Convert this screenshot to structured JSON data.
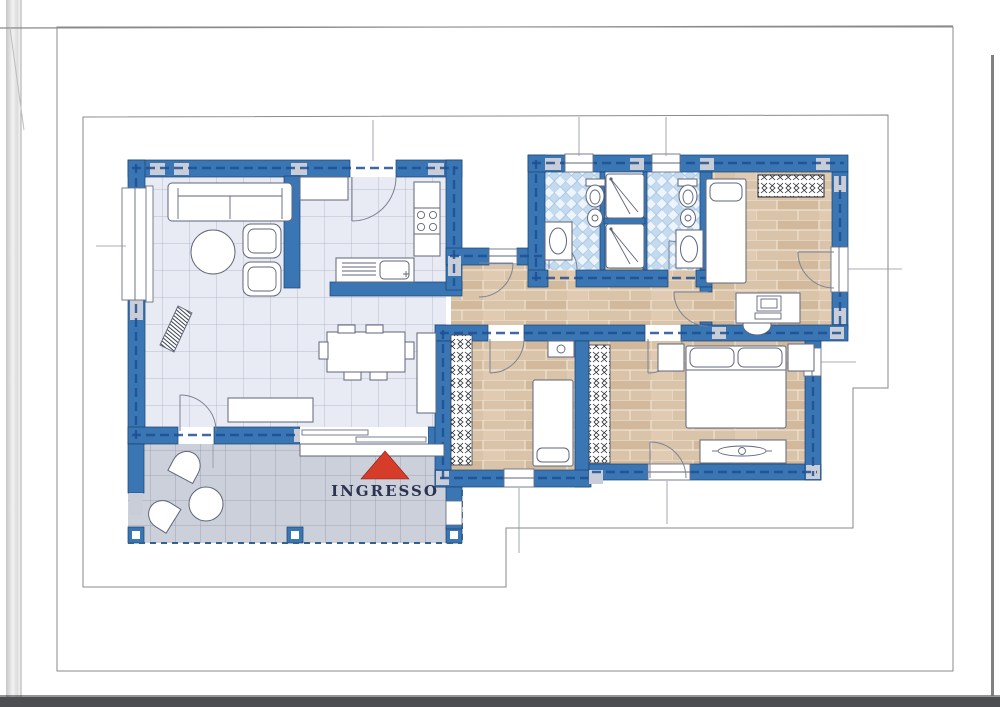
{
  "plan": {
    "entrance_label": "INGRESSO"
  },
  "colors": {
    "wall": "#3b76b4",
    "dash": "#1e4f93",
    "pier": "#c9cdd7",
    "tile": "#e8ebf3",
    "tile_line": "#a9b0c2",
    "terrace": "#ccd0da",
    "terrace_line": "#959bac",
    "parquet": "#d9c3a9",
    "parquet_line": "#f2e9da",
    "bath": "#c3daef",
    "bath_light": "#eef4fb",
    "red": "#d63c2a",
    "navy": "#2c3350",
    "outline": "#5f6678"
  }
}
